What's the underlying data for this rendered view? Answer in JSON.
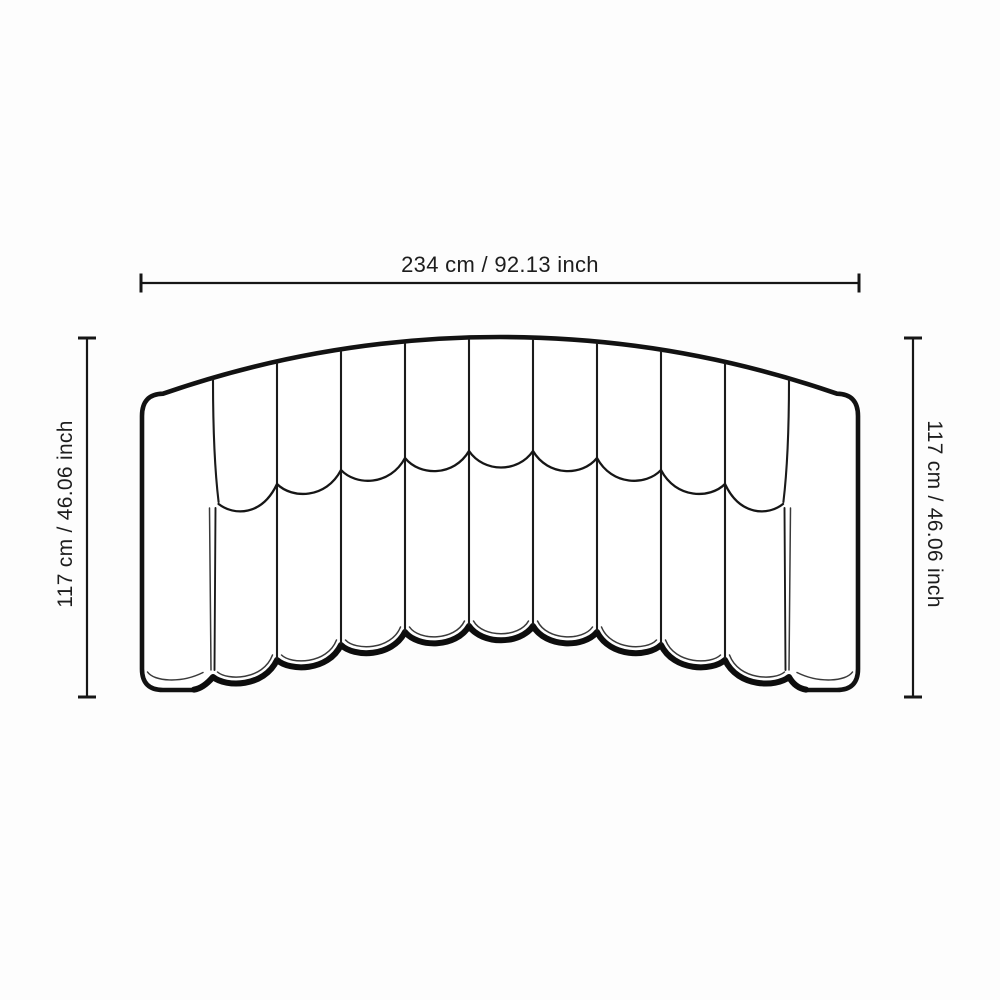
{
  "canvas": {
    "background": "#fdfdfd",
    "ink": "#161616"
  },
  "diagram": {
    "subject": "Curved channel-tufted sofa, front elevation line drawing",
    "panels": {
      "channels": 9,
      "arms": 2
    },
    "width_dimension": {
      "label": "234 cm / 92.13 inch",
      "value_cm": 234,
      "value_inch": 92.13,
      "position": "top"
    },
    "left_height_dimension": {
      "label": "117 cm / 46.06 inch",
      "value_cm": 117,
      "value_inch": 46.06,
      "position": "left"
    },
    "right_height_dimension": {
      "label": "117 cm / 46.06 inch",
      "value_cm": 117,
      "value_inch": 46.06,
      "position": "right"
    }
  }
}
